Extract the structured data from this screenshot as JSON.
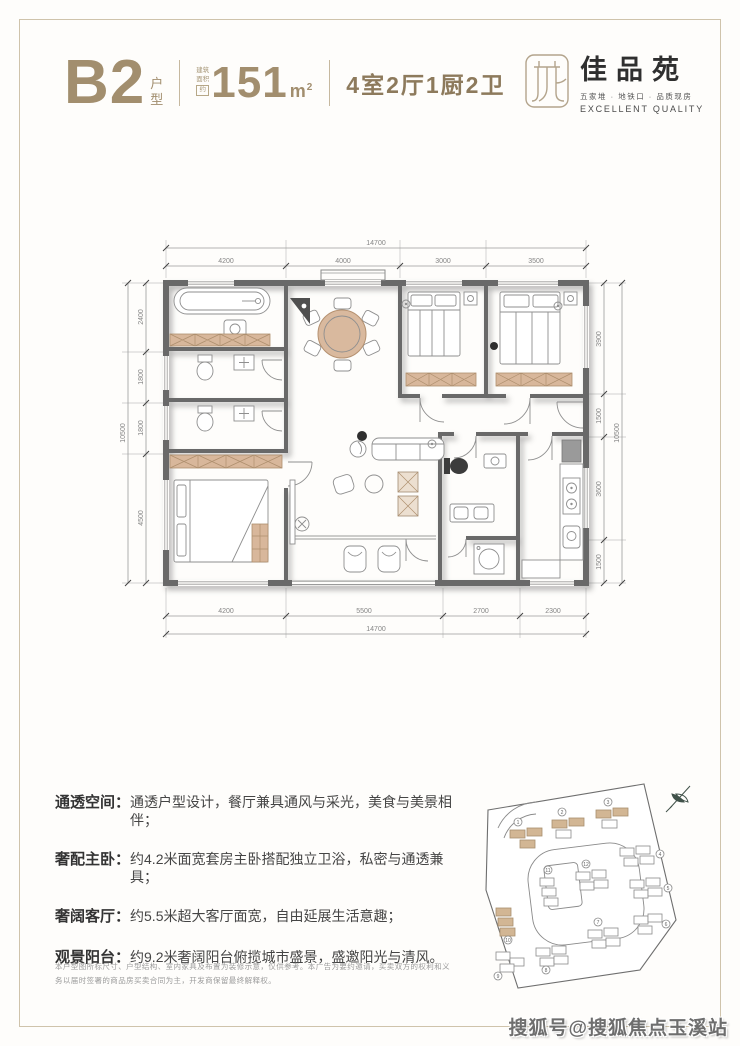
{
  "header": {
    "unit": "B2",
    "unit_suffix_top": "户",
    "unit_suffix_bottom": "型",
    "area_label_top": "建筑",
    "area_label_bottom": "面积",
    "area_approx": "约",
    "area_value": "151",
    "area_unit": "m",
    "area_sup": "2",
    "rooms": "4室2厅1厨2卫"
  },
  "logo": {
    "name": "佳品苑",
    "tagline_cn": "五家堆 · 地铁口 · 品质现房",
    "tagline_en": "EXCELLENT QUALITY"
  },
  "plan": {
    "dims": {
      "top_total": "14700",
      "top": [
        "4200",
        "4000",
        "3000",
        "3500"
      ],
      "bottom": [
        "4200",
        "5500",
        "2700",
        "2300"
      ],
      "bottom_total": "14700",
      "left": [
        "2400",
        "1800",
        "1800",
        "4500"
      ],
      "left_total": "10500",
      "right": [
        "3900",
        "1500",
        "3600",
        "1500"
      ],
      "right_total": "10500"
    }
  },
  "features": [
    {
      "label": "通透空间：",
      "text": "通透户型设计，餐厅兼具通风与采光，美食与美景相伴；"
    },
    {
      "label": "奢配主卧：",
      "text": "约4.2米面宽套房主卧搭配独立卫浴，私密与通透兼具；"
    },
    {
      "label": "奢阔客厅：",
      "text": "约5.5米超大客厅面宽，自由延展生活意趣；"
    },
    {
      "label": "观景阳台：",
      "text": "约9.2米奢阔阳台俯揽城市盛景，盛邀阳光与清风。"
    }
  ],
  "disclaimer": "本户型图所标尺寸、户型结构、室内家具及布置为装修示意，仅供参考。本广告为要约邀请，买卖双方的权利和义务以届时签署的商品房买卖合同为主，开发商保留最终解释权。",
  "site_plan": {
    "numbers": [
      "1",
      "2",
      "3",
      "4",
      "5",
      "6",
      "7",
      "8",
      "9",
      "10",
      "11",
      "12"
    ]
  },
  "watermark": "搜狐号@搜狐焦点玉溪站"
}
